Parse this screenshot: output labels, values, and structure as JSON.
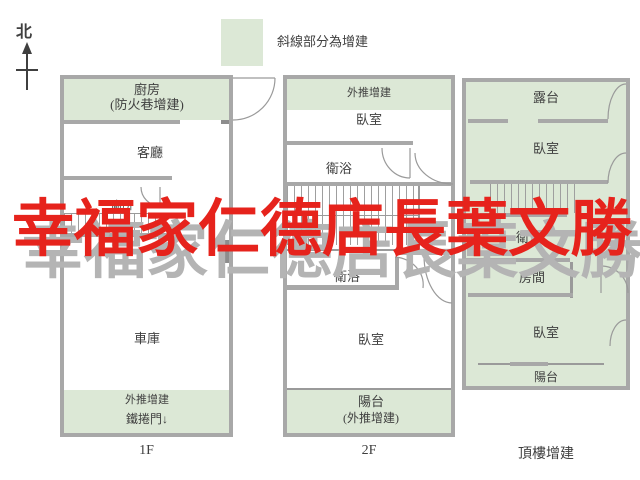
{
  "north": {
    "label": "北"
  },
  "legend": {
    "text": "斜線部分為增建"
  },
  "watermark": {
    "text": [
      "幸",
      "福",
      "家",
      "仁",
      "德",
      "店",
      "長",
      "葉",
      "文",
      "勝"
    ]
  },
  "colors": {
    "addition": "#dce8d6",
    "wall": "#a8a8a8",
    "line": "#9a9a9a",
    "text": "#3f3f3f",
    "watermark_red": "#e6231c",
    "watermark_echo": "#b4b4b4"
  },
  "plans": {
    "f1": {
      "caption": "1F",
      "kitchen": "廚房",
      "kitchen_sub": "(防火巷增建)",
      "living": "客廳",
      "toilet": "廁所",
      "garage": "車庫",
      "push_out": "外推增建",
      "roller_door": "鐵捲門↓"
    },
    "f2": {
      "caption": "2F",
      "push_out": "外推增建",
      "bedroom_top": "臥室",
      "bath_top": "衛浴",
      "bath_mid": "衛浴",
      "bedroom_bottom": "臥室",
      "balcony": "陽台",
      "balcony_sub": "(外推增建)"
    },
    "roof": {
      "caption": "頂樓增建",
      "terrace": "露台",
      "bedroom_top": "臥室",
      "bath": "衛浴",
      "room": "房間",
      "bedroom_bottom": "臥室",
      "balcony": "陽台"
    }
  }
}
